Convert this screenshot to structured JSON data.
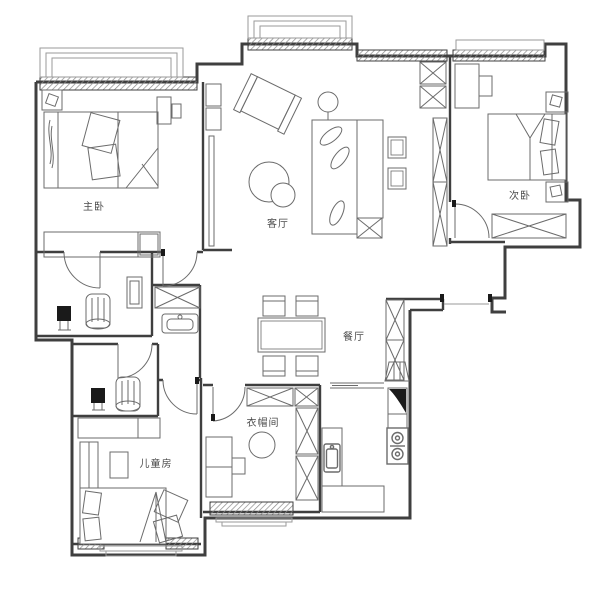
{
  "plan": {
    "type": "apartment-floor-plan",
    "rooms": {
      "master_bedroom": {
        "label": "主卧"
      },
      "living_room": {
        "label": "客厅"
      },
      "second_bedroom": {
        "label": "次卧"
      },
      "dining_room": {
        "label": "餐厅"
      },
      "kids_room": {
        "label": "儿童房"
      },
      "cloakroom": {
        "label": "衣帽间"
      }
    },
    "colors": {
      "wall": "#3f3f3f",
      "furniture": "#6b6b6b",
      "dark_fixture": "#1a1a1a",
      "text": "#4a4a4a",
      "background": "#ffffff"
    }
  }
}
